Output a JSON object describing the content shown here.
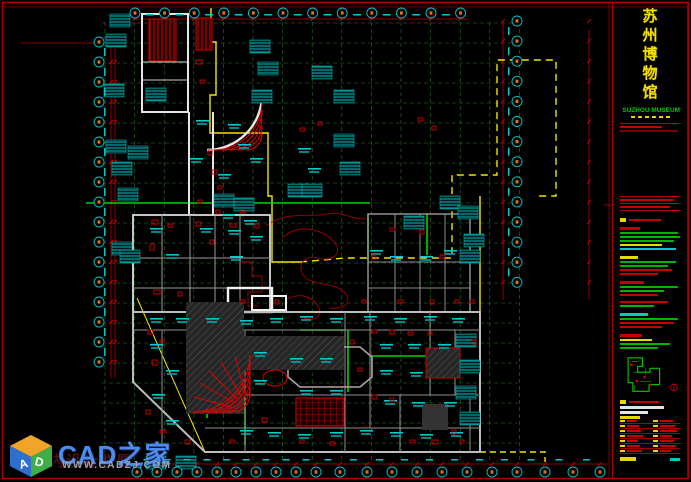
{
  "window": {
    "width": 691,
    "height": 482,
    "background": "#000000"
  },
  "title_block": {
    "project_title_cn": "苏州博物馆",
    "project_title_cn_chars": [
      "苏",
      "州",
      "博",
      "物",
      "馆"
    ],
    "project_title_en": "SUZHOU MUSEUM",
    "rows": [
      {
        "t": "gap",
        "g": 3
      },
      {
        "t": "rule"
      },
      {
        "t": "bar",
        "c": "red",
        "w": 42
      },
      {
        "t": "bar",
        "c": "darkred",
        "w": 58
      },
      {
        "t": "gap",
        "g": 62
      },
      {
        "t": "rule"
      },
      {
        "t": "bar",
        "c": "red",
        "w": 54
      },
      {
        "t": "rule"
      },
      {
        "t": "bar",
        "c": "red",
        "w": 50
      },
      {
        "t": "rule"
      },
      {
        "t": "gap",
        "g": 4
      },
      {
        "t": "chiprow",
        "c": "red",
        "w": 32
      },
      {
        "t": "gap",
        "g": 3
      },
      {
        "t": "hdr",
        "c": "red",
        "w": 20
      },
      {
        "t": "bar",
        "c": "green",
        "w": 58
      },
      {
        "t": "bar",
        "c": "green",
        "w": 60
      },
      {
        "t": "bar",
        "c": "green",
        "w": 54
      },
      {
        "t": "bar",
        "c": "yellow",
        "w": 42
      },
      {
        "t": "bar",
        "c": "cyan",
        "w": 56
      },
      {
        "t": "gap",
        "g": 4
      },
      {
        "t": "hdr",
        "c": "yellow",
        "w": 18
      },
      {
        "t": "bar",
        "c": "green",
        "w": 56
      },
      {
        "t": "bar",
        "c": "green",
        "w": 48
      },
      {
        "t": "bar",
        "c": "red",
        "w": 52
      },
      {
        "t": "bar",
        "c": "red",
        "w": 38
      },
      {
        "t": "gap",
        "g": 4
      },
      {
        "t": "hdr",
        "c": "red",
        "w": 24
      },
      {
        "t": "bar",
        "c": "green",
        "w": 58
      },
      {
        "t": "bar",
        "c": "green",
        "w": 44
      },
      {
        "t": "bar",
        "c": "red",
        "w": 38
      },
      {
        "t": "gap",
        "g": 3
      },
      {
        "t": "bar",
        "c": "red",
        "w": 48
      },
      {
        "t": "bar",
        "c": "green",
        "w": 34
      },
      {
        "t": "gap",
        "g": 4
      },
      {
        "t": "hdr",
        "c": "cyan",
        "w": 28
      },
      {
        "t": "bar",
        "c": "green",
        "w": 58
      },
      {
        "t": "bar",
        "c": "red",
        "w": 54
      },
      {
        "t": "bar",
        "c": "red",
        "w": 42
      },
      {
        "t": "gap",
        "g": 4
      },
      {
        "t": "hdr",
        "c": "red",
        "w": 22
      },
      {
        "t": "bar",
        "c": "yellow",
        "w": 32
      },
      {
        "t": "bar",
        "c": "green",
        "w": 50
      },
      {
        "t": "bar",
        "c": "green",
        "w": 38
      }
    ],
    "fields_rows": 7,
    "scale_bars": {
      "left_w": 16,
      "right_w": 10
    }
  },
  "watermark": {
    "brand": "CAD之家",
    "site": "WWW.CADZJ.COM",
    "faint_text": "室内设计联盟",
    "cube_letters": {
      "left": "A",
      "right": "D"
    }
  },
  "colors": {
    "frame_red": "#a80000",
    "dim_red": "#c00000",
    "grid_green": "#2e8b2e",
    "bright_green": "#00d400",
    "cad_cyan": "#00d2d2",
    "wall_white": "#e6e6e6",
    "wall_gray": "#9a9a9a",
    "boundary_yellow": "#f2e500",
    "hatch_dark": "#2c2c2c",
    "bubble_glyph_orange": "#e07818",
    "brand_blue": "#4d8bf0"
  },
  "plan": {
    "axis": {
      "top": {
        "y": 13,
        "x0": 135,
        "step": 29.6,
        "count": 12
      },
      "left": {
        "x": 99,
        "y0": 42,
        "step": 20,
        "count": 17
      },
      "right": {
        "x": 517,
        "y0": 21,
        "step": 20.1,
        "count": 14
      },
      "bottom": {
        "y": 472,
        "xs": [
          137,
          157,
          177,
          197,
          217,
          236,
          256,
          276,
          296,
          316,
          340,
          367,
          392,
          417,
          442,
          467,
          492,
          517,
          545,
          573,
          600
        ]
      }
    },
    "grid": {
      "v": {
        "x0": 105,
        "step": 29.6,
        "count": 15,
        "y1": 22,
        "y2": 461
      },
      "h": {
        "y0": 23,
        "step": 20,
        "count": 22,
        "x1": 102,
        "x2": 518
      }
    },
    "label_blocks": [
      [
        110,
        14
      ],
      [
        106,
        34
      ],
      [
        104,
        84
      ],
      [
        146,
        88
      ],
      [
        106,
        140
      ],
      [
        128,
        146
      ],
      [
        112,
        162
      ],
      [
        118,
        188
      ],
      [
        112,
        242
      ],
      [
        120,
        250
      ],
      [
        250,
        40
      ],
      [
        258,
        62
      ],
      [
        312,
        66
      ],
      [
        252,
        90
      ],
      [
        334,
        90
      ],
      [
        334,
        134
      ],
      [
        340,
        162
      ],
      [
        288,
        184
      ],
      [
        302,
        184
      ],
      [
        214,
        194
      ],
      [
        234,
        198
      ],
      [
        404,
        216
      ],
      [
        440,
        196
      ],
      [
        458,
        206
      ],
      [
        464,
        234
      ],
      [
        460,
        250
      ],
      [
        456,
        334
      ],
      [
        460,
        360
      ],
      [
        456,
        386
      ],
      [
        460,
        412
      ],
      [
        146,
        456
      ],
      [
        176,
        456
      ]
    ],
    "micro_labels": [
      [
        196,
        120
      ],
      [
        228,
        124
      ],
      [
        238,
        144
      ],
      [
        250,
        158
      ],
      [
        298,
        148
      ],
      [
        308,
        168
      ],
      [
        218,
        174
      ],
      [
        190,
        158
      ],
      [
        222,
        214
      ],
      [
        244,
        220
      ],
      [
        370,
        250
      ],
      [
        390,
        256
      ],
      [
        420,
        256
      ],
      [
        444,
        250
      ],
      [
        150,
        228
      ],
      [
        166,
        254
      ],
      [
        228,
        230
      ],
      [
        250,
        236
      ],
      [
        200,
        228
      ],
      [
        230,
        256
      ],
      [
        150,
        318
      ],
      [
        176,
        318
      ],
      [
        206,
        318
      ],
      [
        240,
        320
      ],
      [
        270,
        318
      ],
      [
        300,
        316
      ],
      [
        330,
        318
      ],
      [
        364,
        316
      ],
      [
        394,
        318
      ],
      [
        424,
        316
      ],
      [
        452,
        318
      ],
      [
        150,
        344
      ],
      [
        166,
        370
      ],
      [
        152,
        394
      ],
      [
        166,
        420
      ],
      [
        240,
        430
      ],
      [
        268,
        432
      ],
      [
        298,
        434
      ],
      [
        330,
        432
      ],
      [
        360,
        430
      ],
      [
        390,
        432
      ],
      [
        420,
        434
      ],
      [
        450,
        432
      ],
      [
        380,
        344
      ],
      [
        408,
        344
      ],
      [
        438,
        344
      ],
      [
        380,
        370
      ],
      [
        410,
        372
      ],
      [
        384,
        400
      ],
      [
        412,
        402
      ],
      [
        444,
        402
      ],
      [
        290,
        358
      ],
      [
        320,
        358
      ],
      [
        254,
        352
      ],
      [
        254,
        380
      ],
      [
        300,
        390
      ],
      [
        330,
        390
      ]
    ],
    "red_bits": [
      [
        152,
        220,
        6,
        4
      ],
      [
        168,
        224,
        5,
        3
      ],
      [
        150,
        244,
        4,
        6
      ],
      [
        196,
        222,
        5,
        4
      ],
      [
        210,
        240,
        4,
        4
      ],
      [
        230,
        224,
        6,
        3
      ],
      [
        255,
        224,
        4,
        4
      ],
      [
        154,
        290,
        6,
        4
      ],
      [
        178,
        292,
        4,
        4
      ],
      [
        240,
        300,
        5,
        3
      ],
      [
        148,
        330,
        5,
        4
      ],
      [
        160,
        340,
        4,
        3
      ],
      [
        152,
        360,
        5,
        5
      ],
      [
        146,
        410,
        4,
        4
      ],
      [
        160,
        430,
        6,
        3
      ],
      [
        185,
        440,
        5,
        4
      ],
      [
        230,
        440,
        4,
        3
      ],
      [
        262,
        418,
        5,
        4
      ],
      [
        350,
        340,
        4,
        4
      ],
      [
        358,
        368,
        4,
        3
      ],
      [
        372,
        330,
        5,
        3
      ],
      [
        390,
        330,
        4,
        4
      ],
      [
        408,
        332,
        5,
        3
      ],
      [
        428,
        332,
        4,
        3
      ],
      [
        372,
        395,
        5,
        4
      ],
      [
        390,
        398,
        4,
        3
      ],
      [
        432,
        440,
        6,
        4
      ],
      [
        452,
        430,
        4,
        4
      ],
      [
        410,
        440,
        5,
        3
      ],
      [
        300,
        440,
        4,
        3
      ],
      [
        330,
        442,
        5,
        3
      ],
      [
        275,
        300,
        4,
        4
      ],
      [
        362,
        300,
        4,
        3
      ],
      [
        398,
        300,
        5,
        3
      ],
      [
        430,
        300,
        4,
        4
      ],
      [
        455,
        300,
        4,
        3
      ],
      [
        372,
        255,
        4,
        4
      ],
      [
        390,
        228,
        5,
        3
      ],
      [
        420,
        230,
        4,
        4
      ],
      [
        440,
        255,
        5,
        3
      ],
      [
        460,
        440,
        4,
        3
      ],
      [
        472,
        340,
        4,
        4
      ],
      [
        470,
        300,
        4,
        3
      ],
      [
        196,
        60,
        6,
        4
      ],
      [
        200,
        80,
        5,
        3
      ],
      [
        208,
        150,
        4,
        5
      ],
      [
        212,
        170,
        5,
        4
      ],
      [
        218,
        186,
        4,
        3
      ],
      [
        240,
        210,
        5,
        3
      ],
      [
        216,
        210,
        4,
        4
      ],
      [
        198,
        200,
        4,
        3
      ],
      [
        418,
        118,
        5,
        3
      ],
      [
        432,
        126,
        4,
        4
      ],
      [
        300,
        128,
        5,
        3
      ],
      [
        318,
        122,
        4,
        3
      ]
    ]
  }
}
